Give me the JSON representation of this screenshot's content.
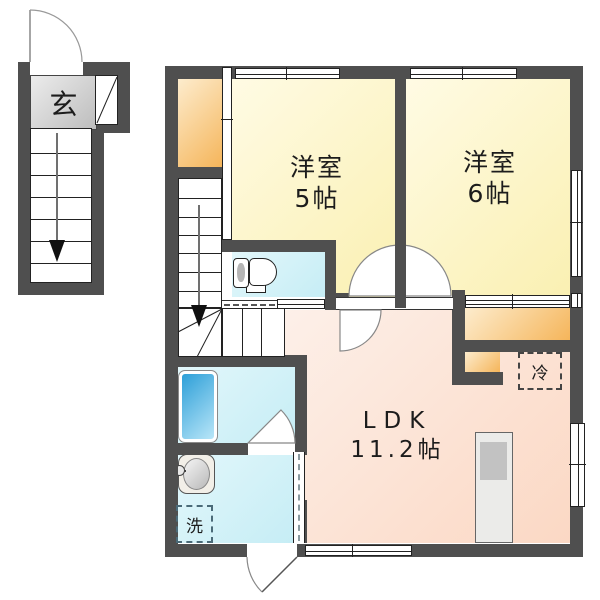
{
  "plan_title": "apartment floor plan",
  "labels": {
    "entrance": "玄",
    "room5": {
      "name": "洋室",
      "size": "5帖"
    },
    "room6": {
      "name": "洋室",
      "size": "6帖"
    },
    "ldk": {
      "name": "LDK",
      "size": "11.2帖"
    },
    "fridge": "冷",
    "laundry": "洗"
  },
  "colors": {
    "wall": "#4f4f4f",
    "room_yellow": "#faf0b2",
    "ldk_pink": "#fbd8c4",
    "wet_cyan": "#c6edf5",
    "closet_orange": "#f5b55a",
    "entrance_gray": "#c9c9c9",
    "bathtub_blue": "#2d9fd8"
  }
}
